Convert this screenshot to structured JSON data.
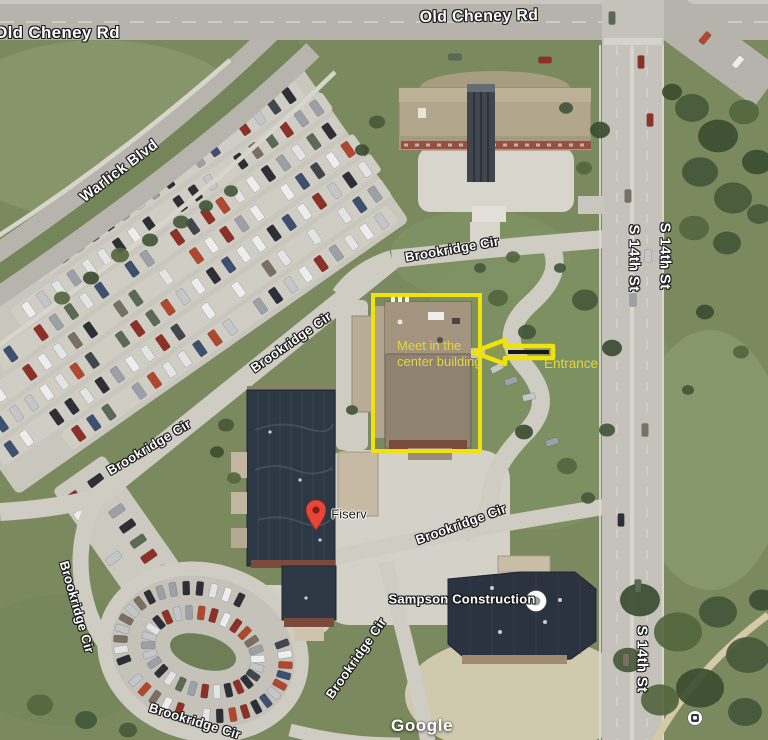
{
  "map": {
    "road_labels": [
      {
        "text": "Old Cheney Rd",
        "x": 57,
        "y": 33,
        "rotate": 0,
        "size": 17
      },
      {
        "text": "Old Cheney Rd",
        "x": 479,
        "y": 17,
        "rotate": -1,
        "size": 16
      },
      {
        "text": "Warlick Blvd",
        "x": 119,
        "y": 171,
        "rotate": -37,
        "size": 15
      },
      {
        "text": "S 14th St",
        "x": 634,
        "y": 258,
        "rotate": 90,
        "size": 15
      },
      {
        "text": "S 14th St",
        "x": 665,
        "y": 256,
        "rotate": 90,
        "size": 15
      },
      {
        "text": "S 14th St",
        "x": 642,
        "y": 659,
        "rotate": 90,
        "size": 15
      },
      {
        "text": "Brookridge Cir",
        "x": 452,
        "y": 249,
        "rotate": -10,
        "size": 13
      },
      {
        "text": "Brookridge Cir",
        "x": 291,
        "y": 342,
        "rotate": -35,
        "size": 13
      },
      {
        "text": "Brookridge Cir",
        "x": 149,
        "y": 447,
        "rotate": -31,
        "size": 13
      },
      {
        "text": "Brookridge Cir",
        "x": 77,
        "y": 607,
        "rotate": 74,
        "size": 13
      },
      {
        "text": "Brookridge Cir",
        "x": 356,
        "y": 658,
        "rotate": -55,
        "size": 13
      },
      {
        "text": "Brookridge Cir",
        "x": 195,
        "y": 721,
        "rotate": 17,
        "size": 13
      },
      {
        "text": "Brookridge Cir",
        "x": 461,
        "y": 524,
        "rotate": -20,
        "size": 13
      }
    ],
    "pois": [
      {
        "name": "Fiserv",
        "type": "red-pin",
        "x": 316,
        "y": 530,
        "label_x": 349,
        "label_y": 514
      },
      {
        "name": "Sampson Construction",
        "type": "white-circle",
        "x": 536,
        "y": 601,
        "label_x": 462,
        "label_y": 599
      },
      {
        "name": "transit-stop",
        "type": "transit",
        "x": 695,
        "y": 718
      }
    ],
    "watermark": "Google"
  },
  "annotations": {
    "note_lines": [
      "Meet in the",
      "center building"
    ],
    "note_x": 397,
    "note_y": 338,
    "entrance_label": "Entrance",
    "entrance_x": 544,
    "entrance_y": 356,
    "box": {
      "x": 371,
      "y": 293,
      "w": 111,
      "h": 160
    },
    "arrow": {
      "tip_x": 473,
      "tip_y": 352,
      "back_x": 505,
      "tail_x": 553,
      "head_half": 12,
      "tail_half": 6
    }
  },
  "colors": {
    "annotation_yellow": "#f2e20b",
    "annotation_text_yellow": "#e6d63a",
    "arrow_core": "#17191c",
    "pin_red": "#e8453a",
    "pin_dot": "#7e1d13",
    "poi_dot_gray": "#9aa0a6",
    "road_label_white": "#ffffff"
  }
}
